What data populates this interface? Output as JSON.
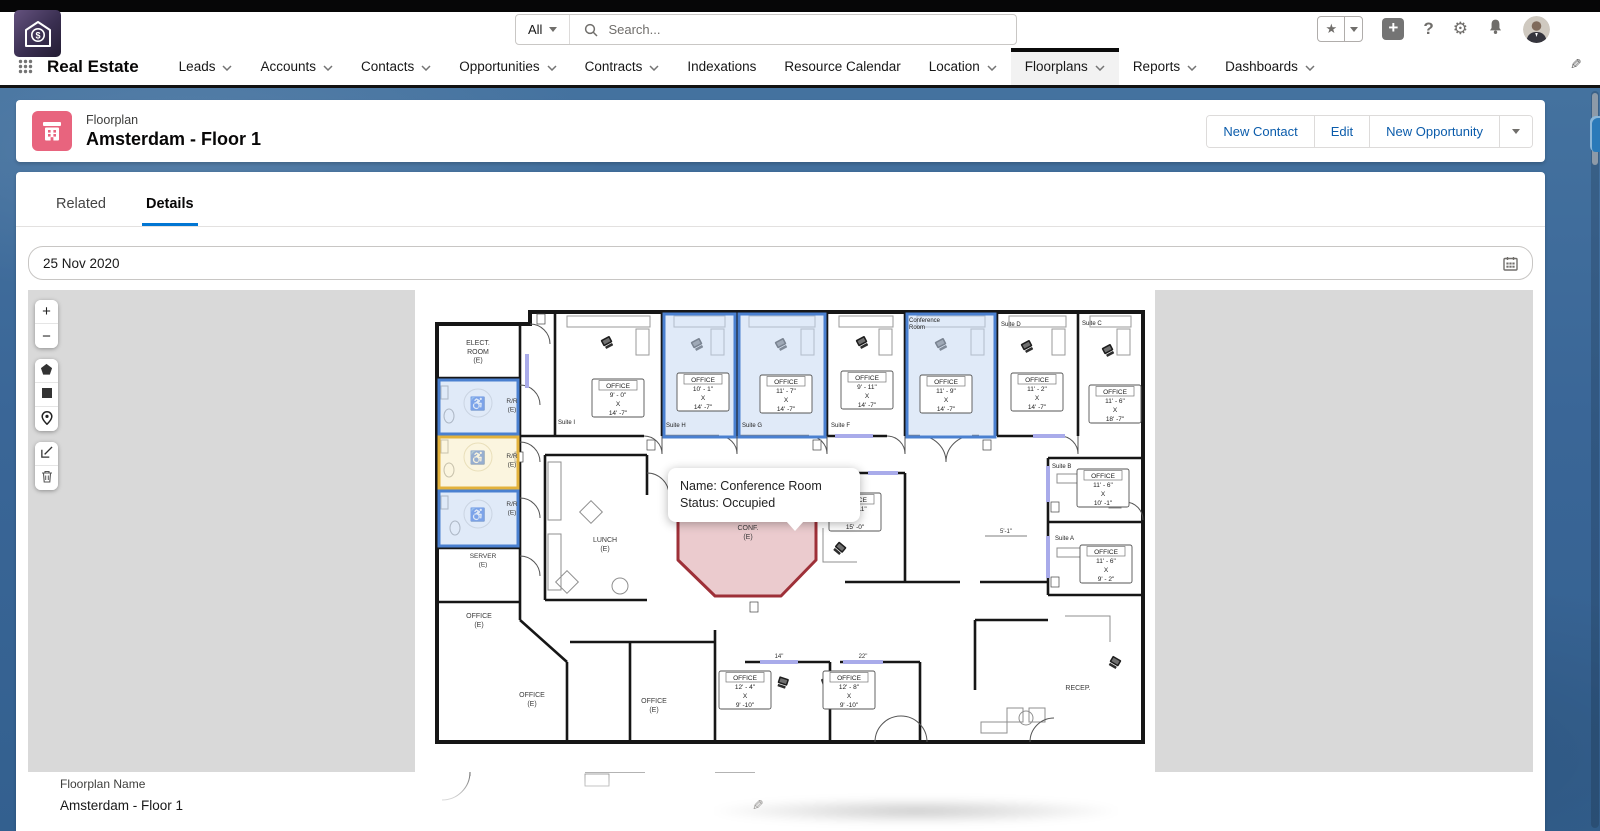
{
  "global_header": {
    "search": {
      "scope": "All",
      "placeholder": "Search..."
    }
  },
  "nav": {
    "app_name": "Real Estate",
    "items": [
      {
        "label": "Leads",
        "caret": true,
        "active": false
      },
      {
        "label": "Accounts",
        "caret": true,
        "active": false
      },
      {
        "label": "Contacts",
        "caret": true,
        "active": false
      },
      {
        "label": "Opportunities",
        "caret": true,
        "active": false
      },
      {
        "label": "Contracts",
        "caret": true,
        "active": false
      },
      {
        "label": "Indexations",
        "caret": false,
        "active": false
      },
      {
        "label": "Resource Calendar",
        "caret": false,
        "active": false
      },
      {
        "label": "Location",
        "caret": true,
        "active": false
      },
      {
        "label": "Floorplans",
        "caret": true,
        "active": true
      },
      {
        "label": "Reports",
        "caret": true,
        "active": false
      },
      {
        "label": "Dashboards",
        "caret": true,
        "active": false
      }
    ]
  },
  "page_header": {
    "entity_label": "Floorplan",
    "title": "Amsterdam - Floor 1",
    "actions": [
      "New Contact",
      "Edit",
      "New Opportunity"
    ]
  },
  "tabs": [
    {
      "label": "Related",
      "active": false
    },
    {
      "label": "Details",
      "active": true
    }
  ],
  "date_field": {
    "value": "25 Nov 2020"
  },
  "toolbar": {
    "groups": [
      [
        "zoom-in",
        "zoom-out"
      ],
      [
        "polygon",
        "rectangle",
        "marker"
      ],
      [
        "edit",
        "delete"
      ]
    ]
  },
  "tooltip": {
    "name_line": "Name: Conference Room",
    "status_line": "Status: Occupied"
  },
  "detail_field": {
    "label": "Floorplan Name",
    "value": "Amsterdam - Floor 1"
  },
  "colors": {
    "accent": "#0176d3",
    "record_icon_pink": "#e8647e",
    "highlight_blue_border": "#4a80d0",
    "highlight_blue_fill": "rgba(199,216,242,0.55)",
    "highlight_yellow_border": "#e3b23c",
    "highlight_yellow_fill": "rgba(248,236,196,0.55)",
    "occupied_red_border": "#9e3038",
    "occupied_red_fill": "rgba(222,169,174,0.6)"
  },
  "floorplan": {
    "suite_labels": [
      {
        "x": 143,
        "y": 134,
        "lines": [
          "Suite I"
        ]
      },
      {
        "x": 251,
        "y": 137,
        "lines": [
          "Suite H"
        ]
      },
      {
        "x": 327,
        "y": 137,
        "lines": [
          "Suite G"
        ]
      },
      {
        "x": 416,
        "y": 137,
        "lines": [
          "Suite F"
        ]
      },
      {
        "x": 494,
        "y": 32,
        "lines": [
          "Conference",
          "Room"
        ]
      },
      {
        "x": 586,
        "y": 36,
        "lines": [
          "Suite D"
        ]
      },
      {
        "x": 667,
        "y": 35,
        "lines": [
          "Suite C"
        ]
      },
      {
        "x": 637,
        "y": 178,
        "lines": [
          "Suite B"
        ]
      },
      {
        "x": 640,
        "y": 250,
        "lines": [
          "Suite A"
        ]
      }
    ],
    "room_texts": [
      {
        "x": 63,
        "y": 55,
        "size": 7,
        "lines": [
          "ELECT.",
          "ROOM",
          "(E)"
        ]
      },
      {
        "x": 97,
        "y": 113,
        "size": 6.5,
        "lines": [
          "R/R",
          "(E)"
        ]
      },
      {
        "x": 97,
        "y": 168,
        "size": 6.5,
        "lines": [
          "R/R",
          "(E)"
        ]
      },
      {
        "x": 97,
        "y": 216,
        "size": 6.5,
        "lines": [
          "R/R",
          "(E)"
        ]
      },
      {
        "x": 68,
        "y": 268,
        "size": 6.5,
        "lines": [
          "SERVER",
          "(E)"
        ]
      },
      {
        "x": 190,
        "y": 252,
        "size": 7,
        "lines": [
          "LUNCH",
          "(E)"
        ]
      },
      {
        "x": 333,
        "y": 240,
        "size": 7,
        "lines": [
          "CONF.",
          "(E)"
        ]
      },
      {
        "x": 64,
        "y": 328,
        "size": 7,
        "lines": [
          "OFFICE",
          "(E)"
        ]
      },
      {
        "x": 117,
        "y": 407,
        "size": 7,
        "lines": [
          "OFFICE",
          "(E)"
        ]
      },
      {
        "x": 239,
        "y": 413,
        "size": 7,
        "lines": [
          "OFFICE",
          "(E)"
        ]
      },
      {
        "x": 663,
        "y": 400,
        "size": 7,
        "lines": [
          "RECEP."
        ]
      }
    ],
    "label_boxes": [
      {
        "x": 203,
        "y": 98,
        "lines": [
          "OFFICE",
          "9' - 0\"",
          "X",
          "14' -7\""
        ]
      },
      {
        "x": 288,
        "y": 92,
        "lines": [
          "OFFICE",
          "10' - 1\"",
          "X",
          "14' -7\""
        ]
      },
      {
        "x": 371,
        "y": 94,
        "lines": [
          "OFFICE",
          "11' - 7\"",
          "X",
          "14' -7\""
        ]
      },
      {
        "x": 452,
        "y": 90,
        "lines": [
          "OFFICE",
          "9' - 11\"",
          "X",
          "14' -7\""
        ]
      },
      {
        "x": 531,
        "y": 94,
        "lines": [
          "OFFICE",
          "11' - 9\"",
          "X",
          "14' -7\""
        ]
      },
      {
        "x": 622,
        "y": 92,
        "lines": [
          "OFFICE",
          "11' - 2\"",
          "X",
          "14' -7\""
        ]
      },
      {
        "x": 700,
        "y": 104,
        "lines": [
          "OFFICE",
          "11' - 6\"",
          "X",
          "18' -7\""
        ]
      },
      {
        "x": 440,
        "y": 212,
        "lines": [
          "OFFICE",
          "10' - 11\"",
          "X",
          "15' -0\""
        ]
      },
      {
        "x": 688,
        "y": 188,
        "lines": [
          "OFFICE",
          "11' - 6\"",
          "X",
          "10' -1\""
        ]
      },
      {
        "x": 691,
        "y": 264,
        "lines": [
          "OFFICE",
          "11' - 6\"",
          "X",
          "9' - 2\""
        ]
      },
      {
        "x": 330,
        "y": 390,
        "lines": [
          "OFFICE",
          "12' - 4\"",
          "X",
          "9' -10\""
        ]
      },
      {
        "x": 434,
        "y": 390,
        "lines": [
          "OFFICE",
          "12' - 8\"",
          "X",
          "9' -10\""
        ]
      }
    ],
    "dims": [
      {
        "x": 364,
        "y": 368,
        "text": "14\""
      },
      {
        "x": 448,
        "y": 368,
        "text": "22\""
      },
      {
        "x": 591,
        "y": 243,
        "text": "5'-1\""
      }
    ],
    "highlights": {
      "rects": [
        {
          "x": 24,
          "y": 90,
          "w": 79,
          "h": 54,
          "c": "blue",
          "name": "restroom-1"
        },
        {
          "x": 24,
          "y": 147,
          "w": 79,
          "h": 51,
          "c": "yellow",
          "name": "restroom-2"
        },
        {
          "x": 24,
          "y": 201,
          "w": 79,
          "h": 55,
          "c": "blue",
          "name": "restroom-3"
        },
        {
          "x": 249,
          "y": 24,
          "w": 71,
          "h": 123,
          "c": "blue",
          "name": "suite-h"
        },
        {
          "x": 324,
          "y": 24,
          "w": 86,
          "h": 123,
          "c": "blue",
          "name": "suite-g"
        },
        {
          "x": 492,
          "y": 24,
          "w": 88,
          "h": 123,
          "c": "blue",
          "name": "conference-room-office"
        }
      ],
      "conference_polygon": "263,224 401,224 401,270 366,306 300,306 263,270"
    }
  }
}
